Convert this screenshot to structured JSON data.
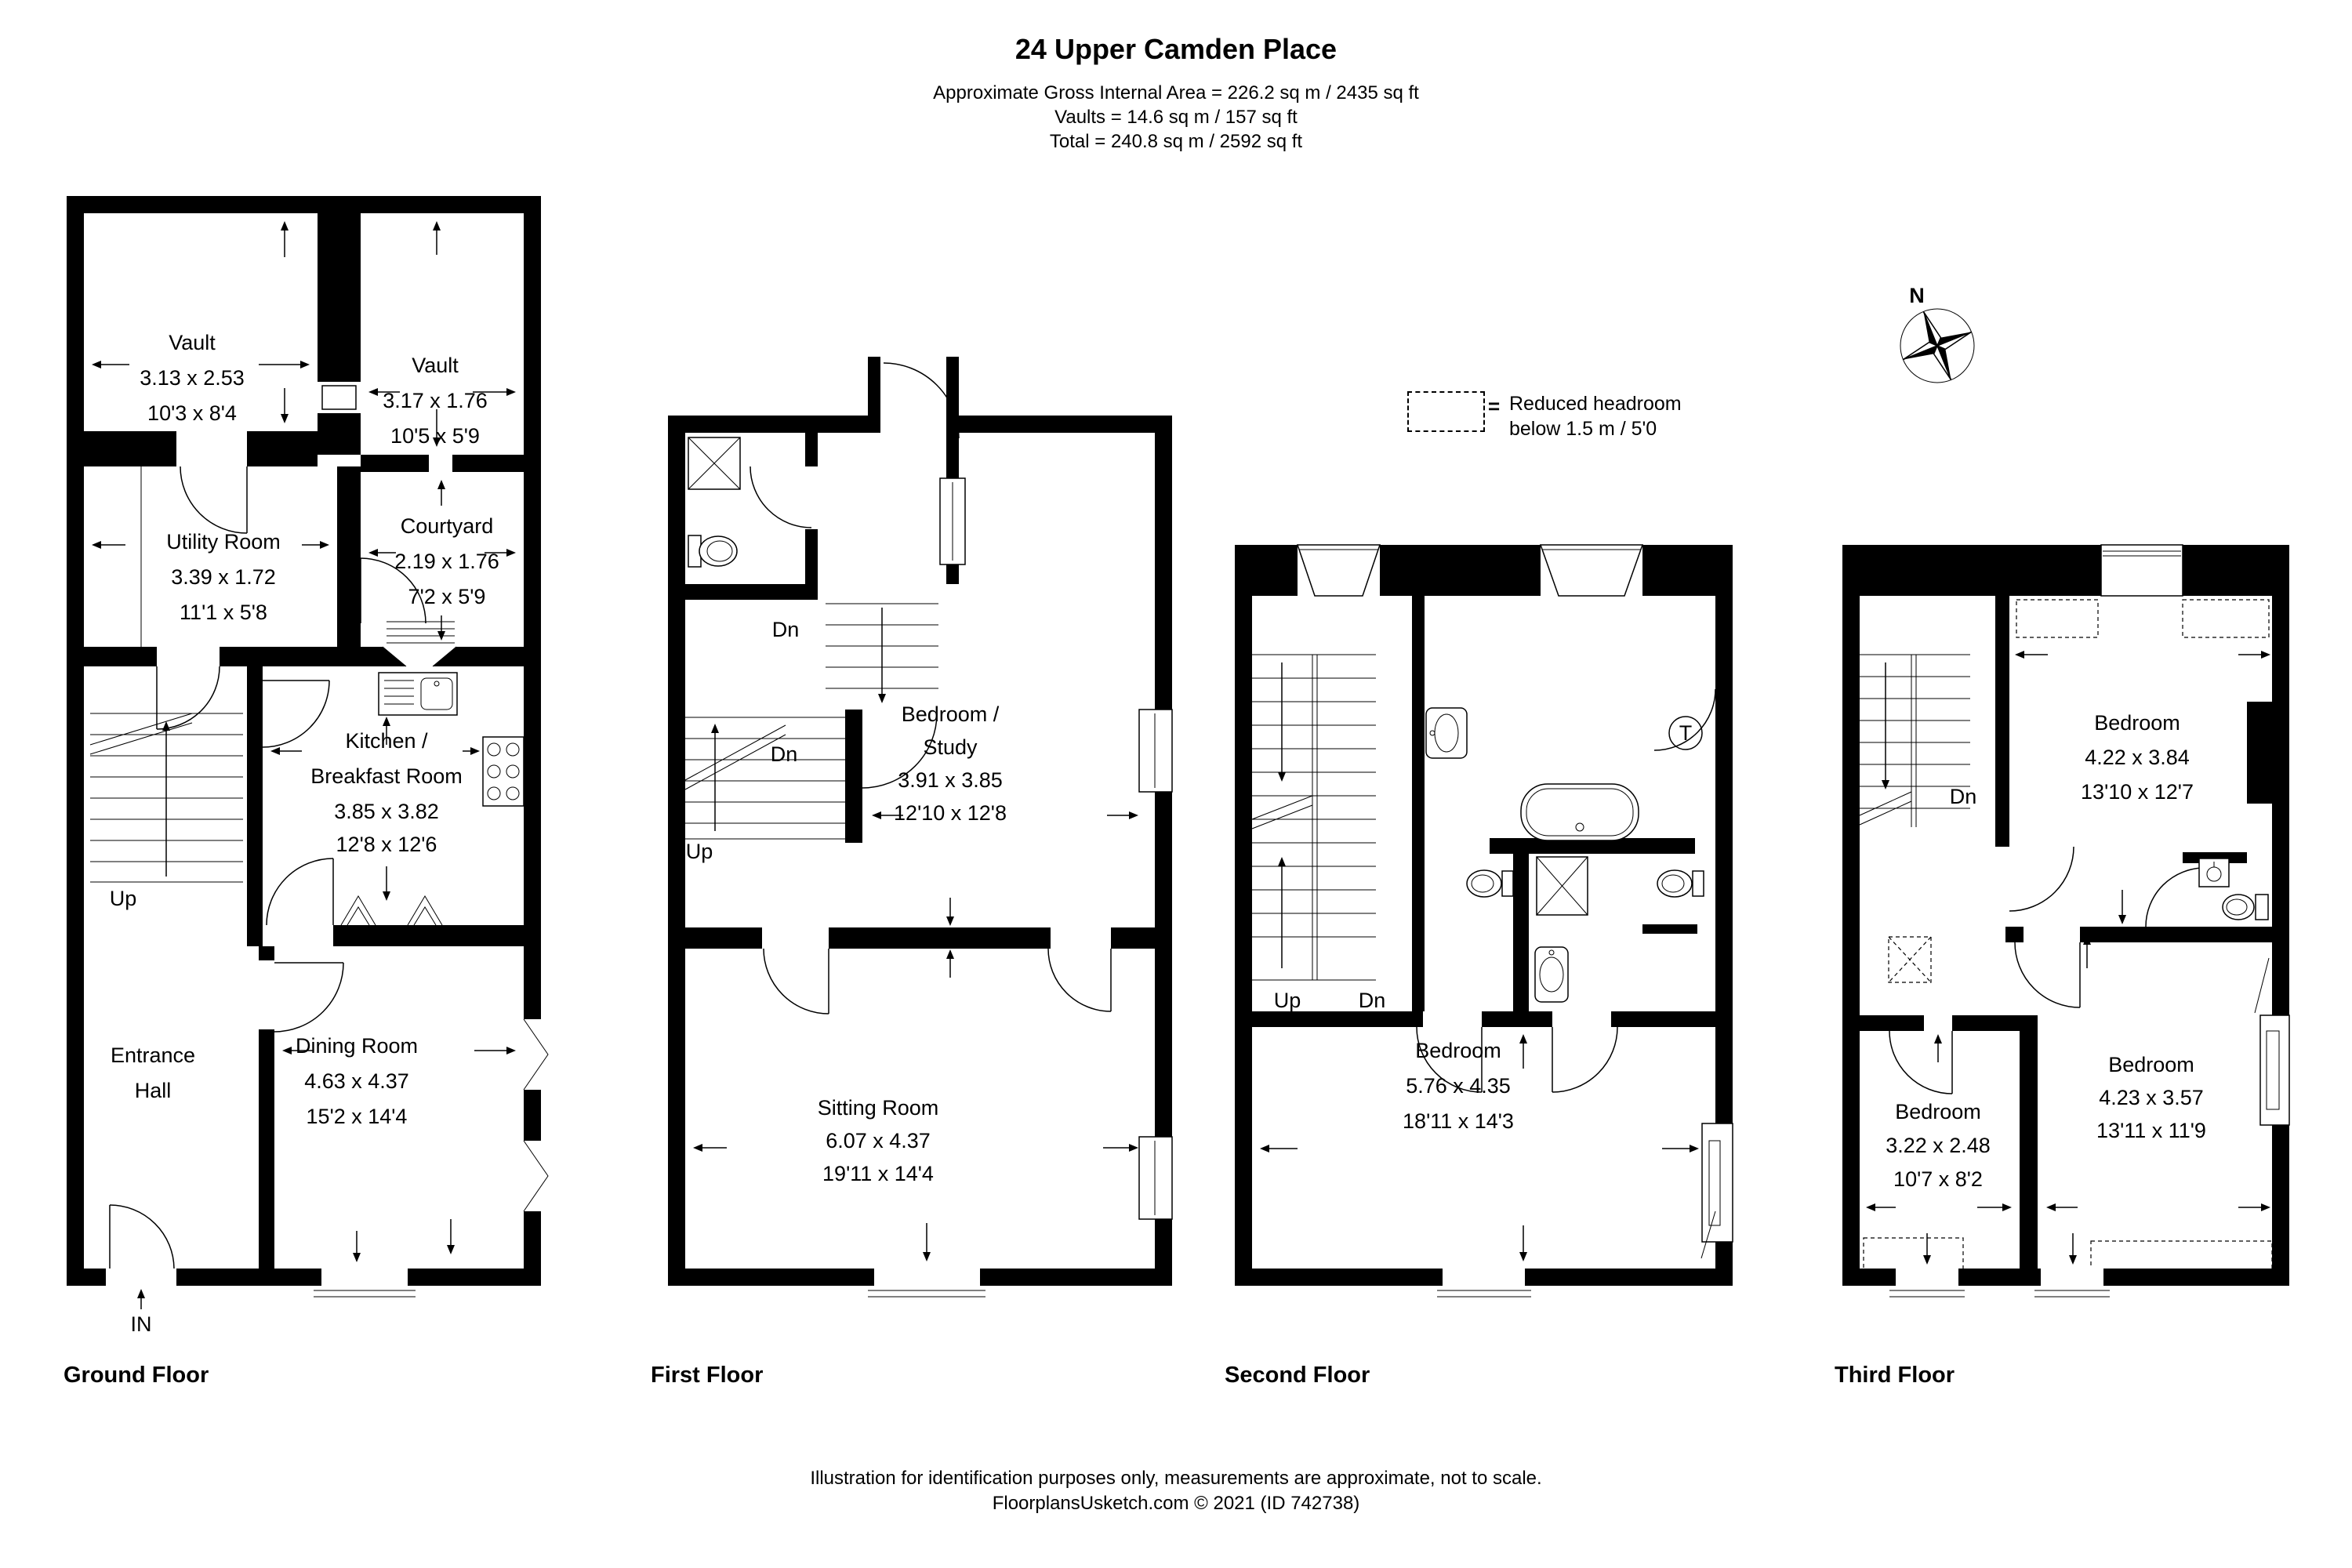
{
  "title": "24 Upper Camden Place",
  "area_summary": {
    "line1": "Approximate Gross Internal Area = 226.2 sq m / 2435 sq ft",
    "line2": "Vaults = 14.6 sq m / 157 sq ft",
    "line3": "Total = 240.8 sq m / 2592 sq ft"
  },
  "compass": {
    "north": "N"
  },
  "legend": {
    "symbol": "=",
    "line1": "Reduced headroom",
    "line2": "below 1.5 m / 5'0"
  },
  "floors": [
    {
      "label": "Ground Floor",
      "rooms": [
        {
          "lines": [
            "Vault",
            "3.13 x 2.53",
            "10'3 x 8'4"
          ]
        },
        {
          "lines": [
            "Vault",
            "3.17 x 1.76",
            "10'5 x 5'9"
          ]
        },
        {
          "lines": [
            "Utility Room",
            "3.39 x 1.72",
            "11'1 x 5'8"
          ]
        },
        {
          "lines": [
            "Courtyard",
            "2.19 x 1.76",
            "7'2 x 5'9"
          ]
        },
        {
          "lines": [
            "Kitchen /",
            "Breakfast Room",
            "3.85 x 3.82",
            "12'8 x 12'6"
          ]
        },
        {
          "lines": [
            "Dining Room",
            "4.63 x 4.37",
            "15'2 x 14'4"
          ]
        },
        {
          "lines": [
            "Entrance",
            "Hall"
          ]
        }
      ],
      "ann": {
        "up": "Up",
        "in": "IN"
      }
    },
    {
      "label": "First Floor",
      "rooms": [
        {
          "lines": [
            "Bedroom /",
            "Study",
            "3.91 x 3.85",
            "12'10 x 12'8"
          ]
        },
        {
          "lines": [
            "Sitting Room",
            "6.07 x 4.37",
            "19'11 x 14'4"
          ]
        }
      ],
      "ann": {
        "dn_upper": "Dn",
        "dn_lower": "Dn",
        "up": "Up"
      }
    },
    {
      "label": "Second Floor",
      "rooms": [
        {
          "lines": [
            "Bedroom",
            "5.76 x 4.35",
            "18'11 x 14'3"
          ]
        }
      ],
      "ann": {
        "up": "Up",
        "dn": "Dn",
        "tank": "T"
      }
    },
    {
      "label": "Third Floor",
      "rooms": [
        {
          "lines": [
            "Bedroom",
            "4.22 x 3.84",
            "13'10 x 12'7"
          ]
        },
        {
          "lines": [
            "Bedroom",
            "3.22 x 2.48",
            "10'7 x 8'2"
          ]
        },
        {
          "lines": [
            "Bedroom",
            "4.23 x 3.57",
            "13'11 x 11'9"
          ]
        }
      ],
      "ann": {
        "dn": "Dn"
      }
    }
  ],
  "footer": {
    "line1": "Illustration for identification purposes only, measurements are approximate, not to scale.",
    "line2": "FloorplansUsketch.com © 2021 (ID 742738)"
  }
}
